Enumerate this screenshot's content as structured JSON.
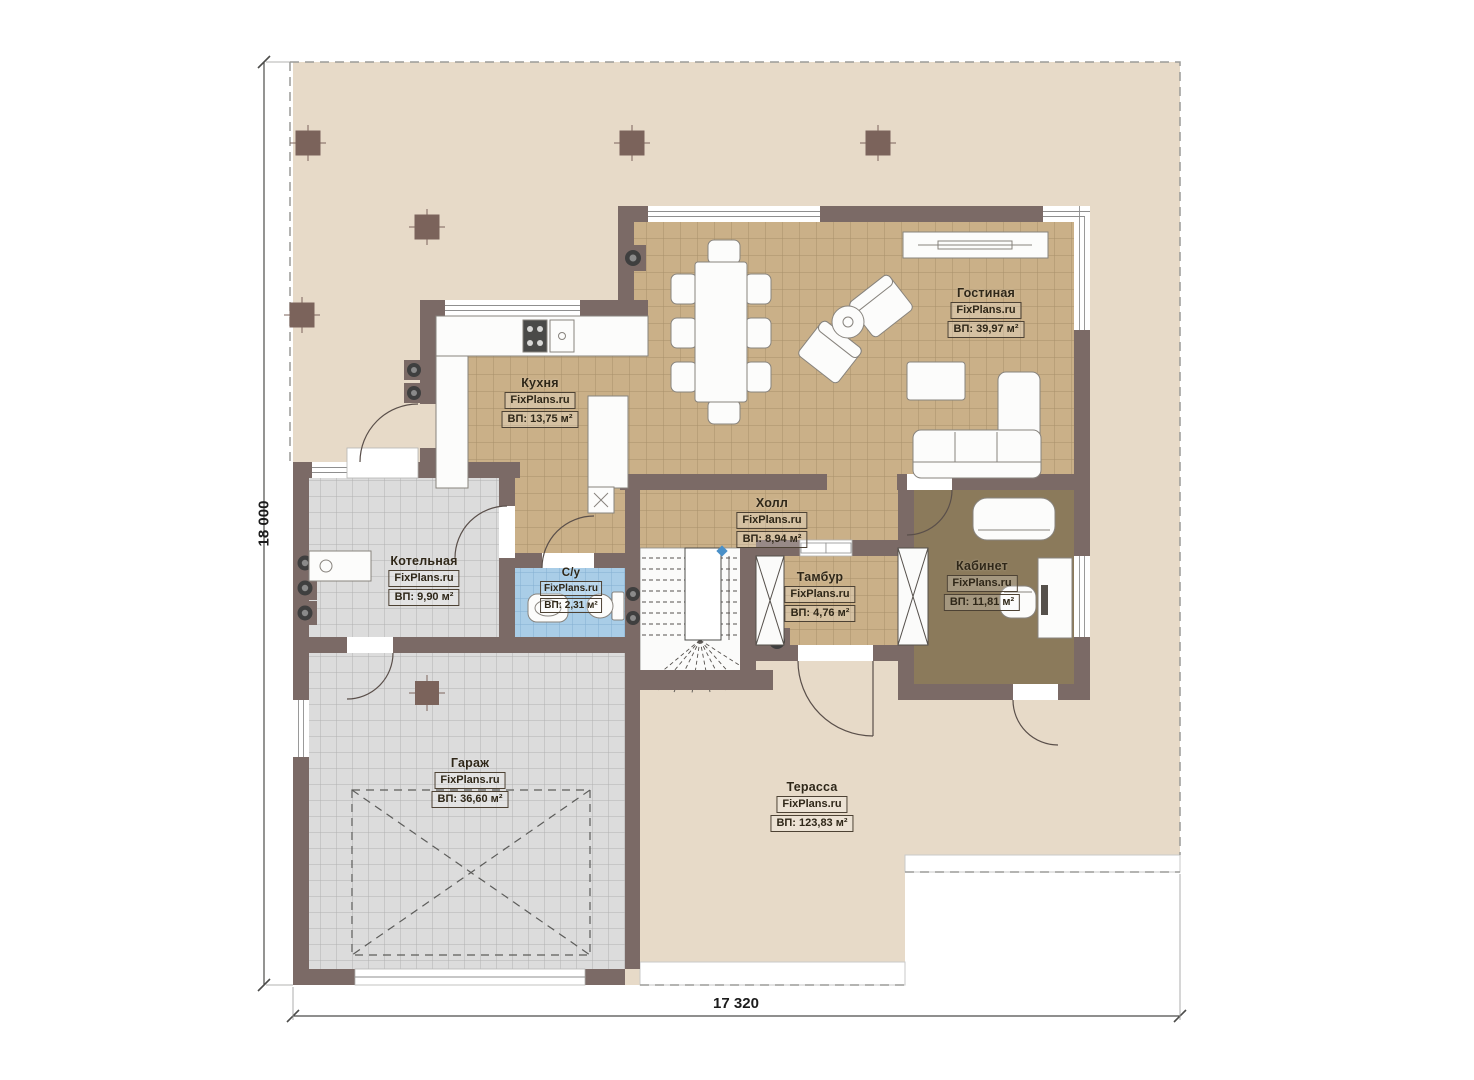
{
  "plan": {
    "dim_height": "18 000",
    "dim_width": "17 320",
    "rooms": [
      {
        "id": "living",
        "name": "Гостиная",
        "brand": "FixPlans.ru",
        "area": "ВП: 39,97 м²"
      },
      {
        "id": "kitchen",
        "name": "Кухня",
        "brand": "FixPlans.ru",
        "area": "ВП: 13,75 м²"
      },
      {
        "id": "hall",
        "name": "Холл",
        "brand": "FixPlans.ru",
        "area": "ВП: 8,94 м²"
      },
      {
        "id": "boiler",
        "name": "Котельная",
        "brand": "FixPlans.ru",
        "area": "ВП: 9,90 м²"
      },
      {
        "id": "wc",
        "name": "С/у",
        "brand": "FixPlans.ru",
        "area": "ВП: 2,31 м²"
      },
      {
        "id": "vestibule",
        "name": "Тамбур",
        "brand": "FixPlans.ru",
        "area": "ВП: 4,76 м²"
      },
      {
        "id": "office",
        "name": "Кабинет",
        "brand": "FixPlans.ru",
        "area": "ВП: 11,81 м²"
      },
      {
        "id": "garage",
        "name": "Гараж",
        "brand": "FixPlans.ru",
        "area": "ВП: 36,60 м²"
      },
      {
        "id": "terrace",
        "name": "Терасса",
        "brand": "FixPlans.ru",
        "area": "ВП: 123,83 м²"
      }
    ],
    "colors": {
      "wall": "#7b6a66",
      "terrace": "#e7dac8",
      "tile_tan": "#cab088",
      "tile_gray": "#dcdcdc",
      "tile_blue": "#a9cde7",
      "office_carpet": "#8b7a5b",
      "marker_blue": "#4a90c8"
    }
  }
}
